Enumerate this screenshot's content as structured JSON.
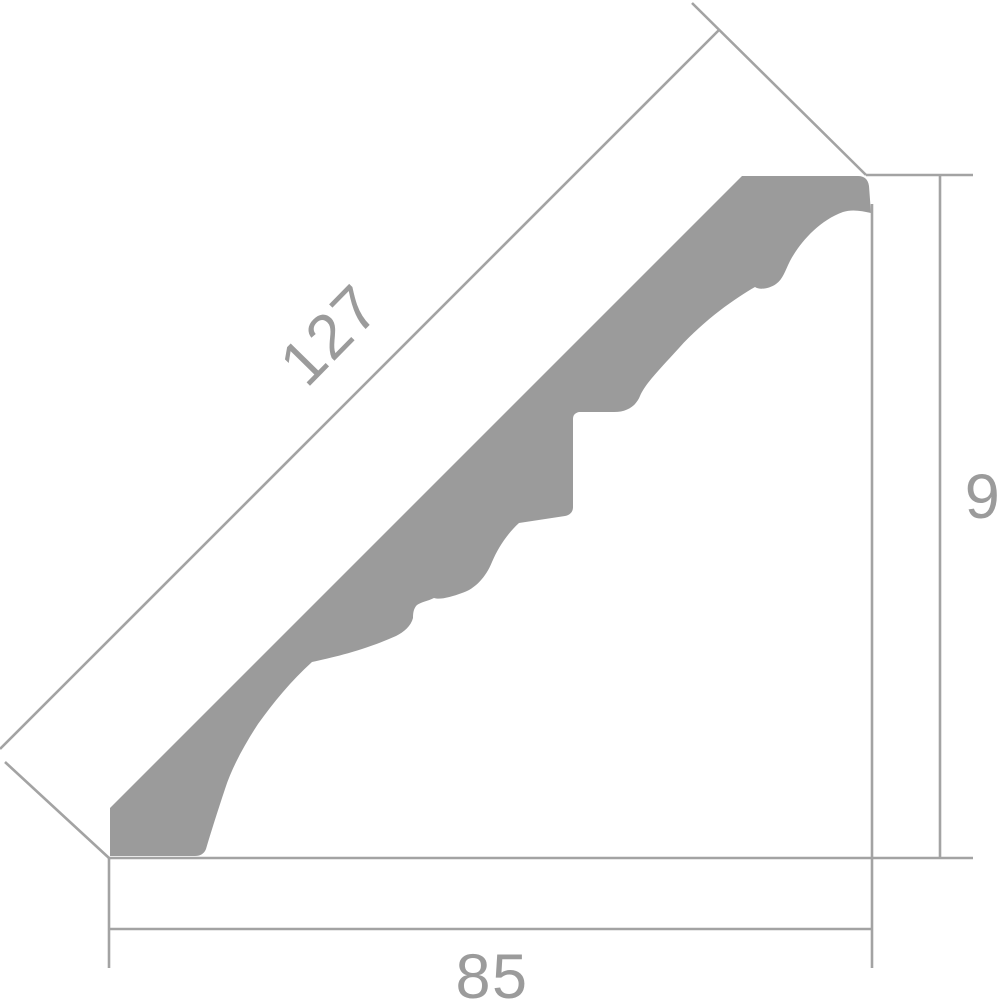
{
  "drawing": {
    "description": "Crown molding cornice cross-section profile with dimension lines",
    "labels": {
      "face_length": "127",
      "height": "9",
      "width": "85"
    },
    "colors": {
      "background": "#ffffff",
      "profile_fill": "#9b9b9b",
      "dimension_line": "#a3a3a3",
      "label_text": "#9b9b9b"
    }
  }
}
